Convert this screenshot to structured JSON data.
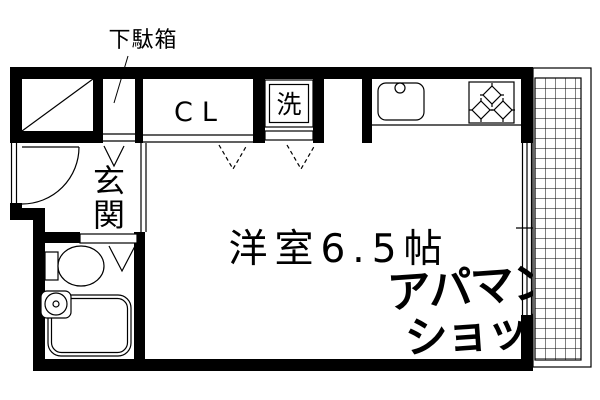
{
  "floorplan": {
    "type": "japanese-apartment-floor-plan",
    "colors": {
      "background": "#ffffff",
      "walls": "#000000",
      "watermark": "#d5d5d5"
    },
    "labels": {
      "shoe_cabinet": "下駄箱",
      "closet": "CL",
      "washer": "洗",
      "entrance": "玄関",
      "main_room": "洋室6.5帖"
    },
    "watermark": {
      "line1": "アパマン",
      "line2": "ショップ"
    },
    "fixtures": [
      "shaft-diagonal-area",
      "shoe-cabinet",
      "closet",
      "washing-machine-space",
      "kitchen-sink",
      "stove-3-burner",
      "entrance-door",
      "bathroom-toilet",
      "bathroom-bathtub",
      "sliding-window",
      "balcony-grid"
    ]
  }
}
